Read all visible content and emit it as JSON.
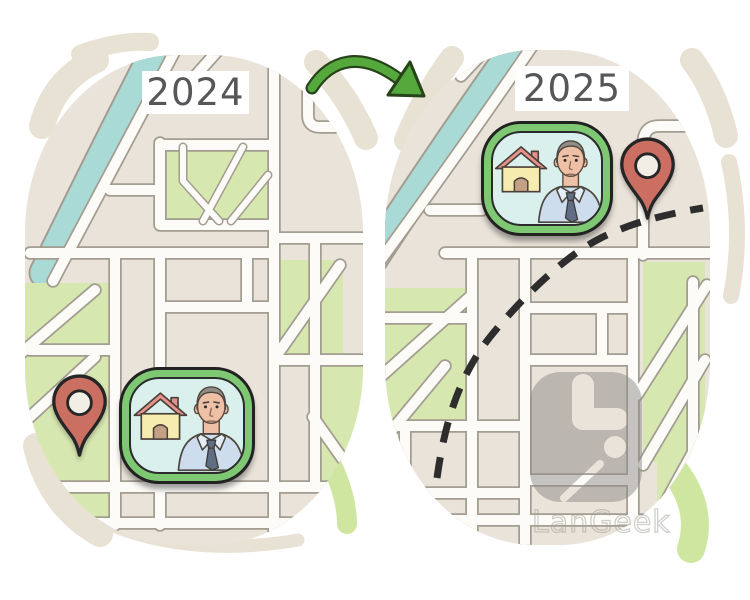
{
  "maps": {
    "left": {
      "year_label": "2024"
    },
    "right": {
      "year_label": "2025"
    }
  },
  "watermark": {
    "brand": "LanGeek"
  },
  "icons": {
    "marker": "house-with-man-badge",
    "pin": "location-pin",
    "arrow": "curved-arrow-right",
    "route": "dashed-route-path",
    "logo": "langeek-rounded-square-logo"
  },
  "colors": {
    "map_bg": "#e9e3d9",
    "road": "#fcfbf7",
    "road_casing": "#a39d91",
    "park": "#d7e7b0",
    "river": "#a9dad5",
    "pin": "#cb6f63",
    "pin_hole": "#f1eee6",
    "badge_green": "#7ec873",
    "badge_inner": "#d9f0ec",
    "arrow": "#55a93c",
    "arrow_outline": "#27431a",
    "dash": "#2d2d2d",
    "label_text": "#57575a",
    "label_bg": "#ffffff",
    "watermark_gray": "#8e8c88",
    "stroke_beige": "#e8e2d4",
    "stroke_green": "#cfe6a0",
    "outline_dark": "#222222"
  }
}
